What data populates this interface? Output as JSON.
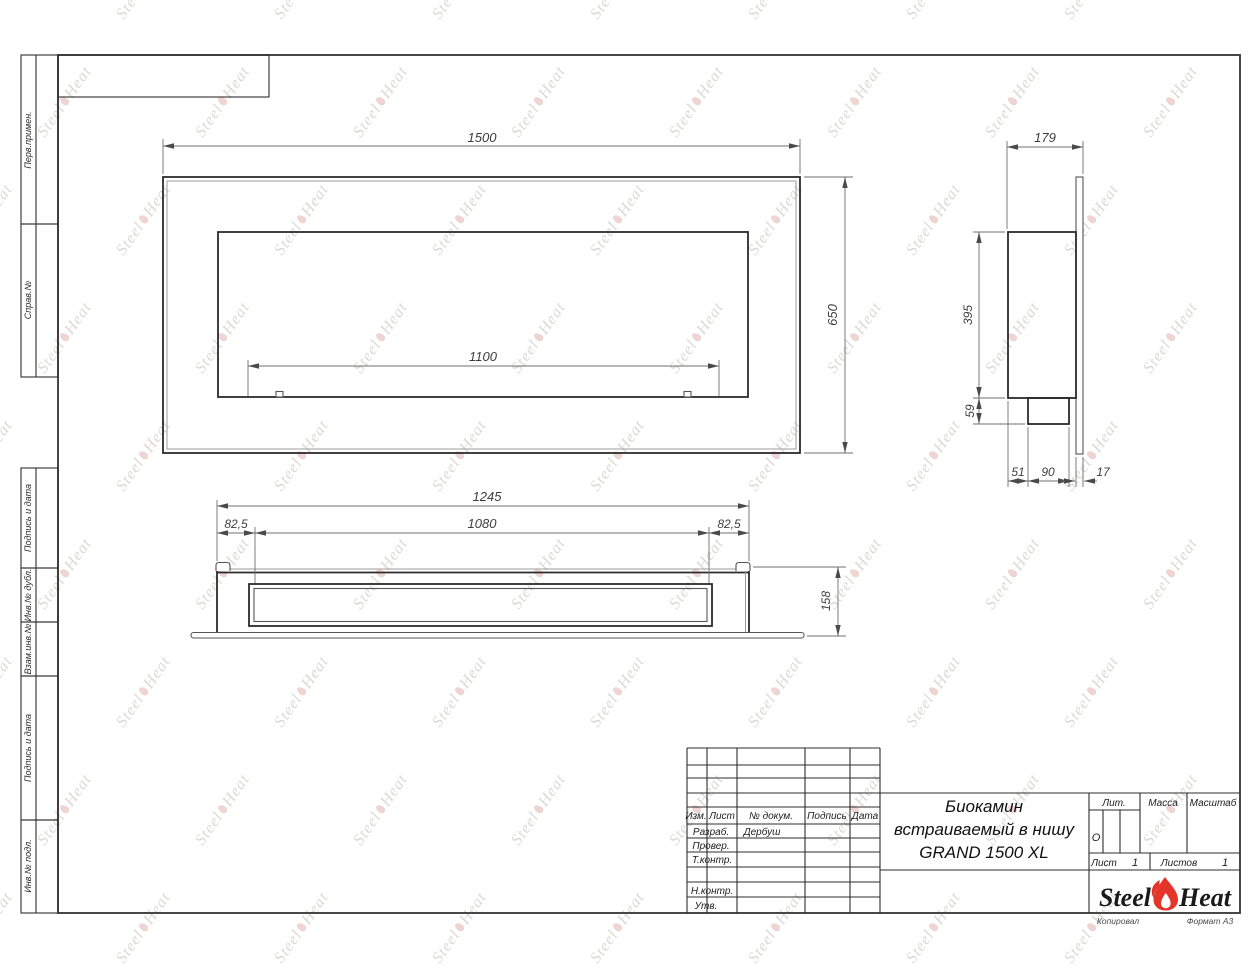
{
  "watermark": {
    "steel": "Steel",
    "heat": "Heat"
  },
  "margin_labels": {
    "perv": "Перв.примен.",
    "sprav": "Справ.№",
    "podp1": "Подпись и дата",
    "dubl": "Инв.№ дубл.",
    "vzam": "Взам.инв.№",
    "podp2": "Подпись и дата",
    "podl": "Инв.№ подл."
  },
  "front_view": {
    "width": "1500",
    "height": "650",
    "opening": "1100"
  },
  "side_view": {
    "depth": "179",
    "body_height": "395",
    "burner_height": "59",
    "burner_offset": "51",
    "burner_depth": "90",
    "panel_thickness": "17"
  },
  "top_view": {
    "width": "1245",
    "margin_left": "82,5",
    "opening": "1080",
    "margin_right": "82,5",
    "depth": "158"
  },
  "title_block": {
    "col_izm": "Изм.",
    "col_list": "Лист",
    "col_doc": "№ докум.",
    "col_sign": "Подпись",
    "col_date": "Дата",
    "dev_label": "Разраб.",
    "dev_value": "Дербуш",
    "check_label": "Провер.",
    "tcontr_label": "Т.контр.",
    "ncontr_label": "Н.контр.",
    "approve_label": "Утв.",
    "title_line1": "Биокамин",
    "title_line2": "встраиваемый в нишу",
    "title_line3": "GRAND 1500 XL",
    "lit_label": "Лит.",
    "lit_value": "О",
    "mass_label": "Масса",
    "scale_label": "Масштаб",
    "sheet_label": "Лист",
    "sheet_value": "1",
    "sheets_label": "Листов",
    "sheets_value": "1",
    "logo_left": "Steel",
    "logo_right": "Heat",
    "footer_copied": "Копировал",
    "footer_format": "Формат А3"
  }
}
